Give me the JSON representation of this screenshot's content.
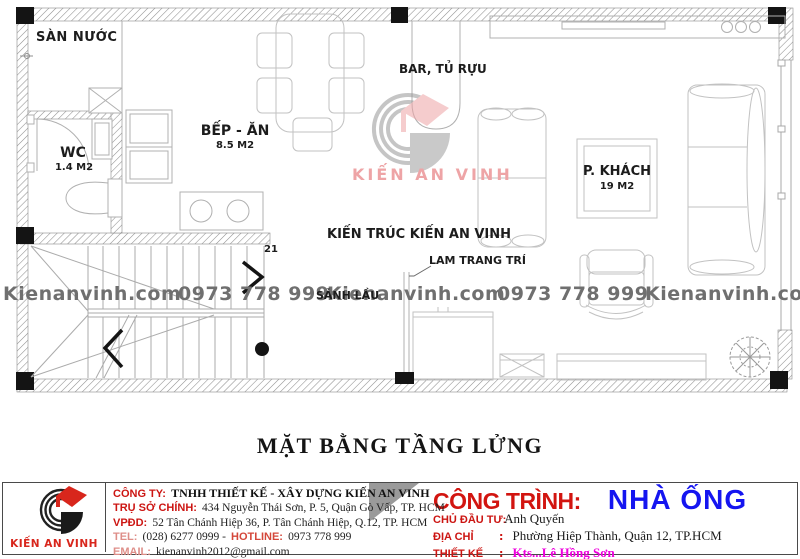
{
  "plan": {
    "labels": {
      "san_nuoc": "SÀN NƯỚC",
      "wc_name": "WC",
      "wc_area": "1.4 M2",
      "bep_name": "BẾP - ĂN",
      "bep_area": "8.5 M2",
      "bar": "BAR, TỦ RỰU",
      "khach_name": "P. KHÁCH",
      "khach_area": "19 M2",
      "sanh_lau": "SẢNH LẦU",
      "studio_note": "KIẾN TRÚC KIẾN AN VINH",
      "lam_note": "LAM TRANG TRÍ",
      "step_count": "21"
    },
    "watermarks": {
      "site": "Kienanvinh.com",
      "phone": "0973 778 999",
      "logo_text": "KIẾN AN VINH"
    }
  },
  "title": "MẶT BẰNG TẦNG LỬNG",
  "footer": {
    "logo_text": "KIẾN AN VINH",
    "company": {
      "row1_label": "CÔNG TY:",
      "row1_value": "TNHH THIẾT KẾ - XÂY DỰNG KIẾN AN VINH",
      "row2_label": "TRỤ SỞ CHÍNH:",
      "row2_value": "434 Nguyễn Thái Sơn, P. 5, Quận Gò Vấp, TP. HCM",
      "row3_label": "VPĐD:",
      "row3_value": "52 Tân Chánh Hiệp 36, P. Tân Chánh Hiệp, Q.12, TP. HCM",
      "row4_label": "TEL:",
      "row4_value": "(028) 6277 0999 -",
      "row4_label2": "HOTLINE:",
      "row4_value2": "0973 778 999",
      "row5_label": "EMAIL:",
      "row5_value": "kienanvinh2012@gmail.com"
    },
    "project": {
      "heading_label": "CÔNG TRÌNH:",
      "heading_value": "NHÀ ỐNG",
      "row1_label": "CHỦ ĐẦU TƯ:",
      "row1_value": "Anh Quyến",
      "row2_label": "ĐỊA CHỈ",
      "row2_colon": ":",
      "row2_value": "Phường Hiệp Thành, Quận 12, TP.HCM",
      "row3_label": "THIẾT KẾ",
      "row3_colon": ":",
      "row3_value": "Kts...Lê Hồng Sơn"
    }
  },
  "colors": {
    "accent_red": "#cc1512",
    "project_blue": "#1515f0",
    "designer_magenta": "#ee00dd",
    "logo_red": "#d8261c",
    "watermark_gray": "#6f6f6f",
    "watermark_pink": "#eea4a6"
  }
}
